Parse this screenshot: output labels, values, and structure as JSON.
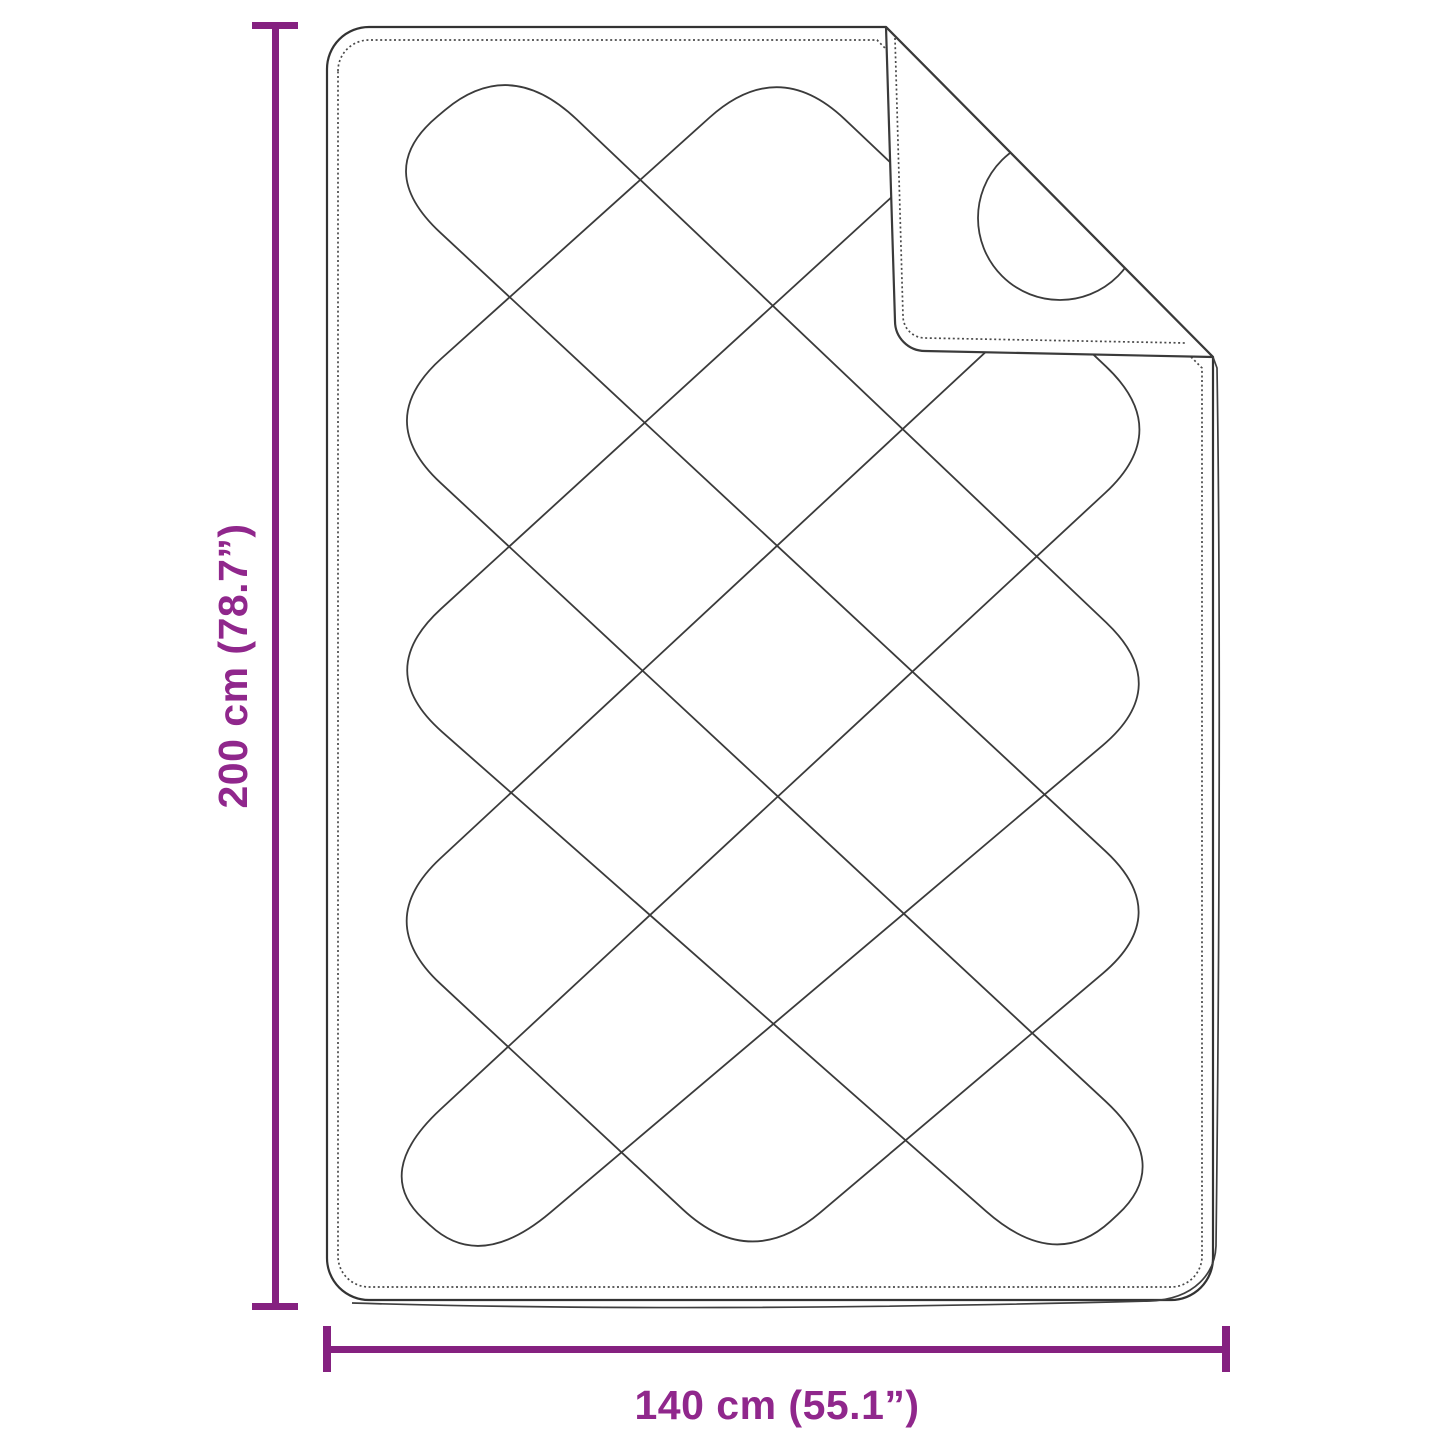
{
  "diagram": {
    "title": "quilted-blanket-dimension-diagram",
    "height_label": "200 cm (78.7”)",
    "width_label": "140 cm (55.1”)",
    "colors": {
      "dimension_line": "#852180",
      "dimension_text": "#90278C",
      "outline": "#3a3a3a",
      "stitch": "#4a4a4a",
      "background": "#ffffff"
    }
  }
}
